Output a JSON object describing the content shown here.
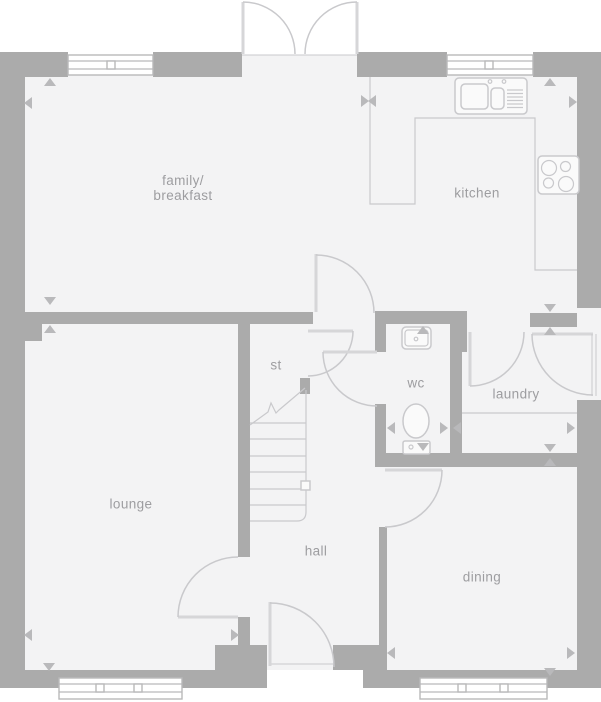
{
  "colors": {
    "wall": "#ababab",
    "floor": "#f3f3f4",
    "fixture_line": "#c9c9cc",
    "door_leaf": "#d6d6d8",
    "window_frame": "#b9b9ba",
    "label_text": "#9d9da0",
    "dimension_marker": "#b9b9bb",
    "background": "#ffffff"
  },
  "rooms": [
    {
      "id": "family-breakfast",
      "lines": [
        "family/",
        "breakfast"
      ]
    },
    {
      "id": "kitchen",
      "label": "kitchen"
    },
    {
      "id": "store",
      "label": "st"
    },
    {
      "id": "wc",
      "label": "wc"
    },
    {
      "id": "laundry",
      "label": "laundry"
    },
    {
      "id": "lounge",
      "label": "lounge"
    },
    {
      "id": "hall",
      "label": "hall"
    },
    {
      "id": "dining",
      "label": "dining"
    }
  ],
  "markers": [
    {
      "x": 50,
      "y": 82,
      "dir": "up"
    },
    {
      "x": 28,
      "y": 103,
      "dir": "left"
    },
    {
      "x": 365,
      "y": 101,
      "dir": "right"
    },
    {
      "x": 372,
      "y": 101,
      "dir": "left"
    },
    {
      "x": 573,
      "y": 102,
      "dir": "right"
    },
    {
      "x": 550,
      "y": 82,
      "dir": "up"
    },
    {
      "x": 550,
      "y": 308,
      "dir": "down"
    },
    {
      "x": 550,
      "y": 331,
      "dir": "up"
    },
    {
      "x": 50,
      "y": 301,
      "dir": "down"
    },
    {
      "x": 50,
      "y": 329,
      "dir": "up"
    },
    {
      "x": 49,
      "y": 667,
      "dir": "down"
    },
    {
      "x": 28,
      "y": 635,
      "dir": "left"
    },
    {
      "x": 235,
      "y": 635,
      "dir": "right"
    },
    {
      "x": 423,
      "y": 330,
      "dir": "up"
    },
    {
      "x": 423,
      "y": 447,
      "dir": "down"
    },
    {
      "x": 391,
      "y": 428,
      "dir": "left"
    },
    {
      "x": 444,
      "y": 428,
      "dir": "right"
    },
    {
      "x": 457,
      "y": 428,
      "dir": "left"
    },
    {
      "x": 571,
      "y": 428,
      "dir": "right"
    },
    {
      "x": 550,
      "y": 448,
      "dir": "down"
    },
    {
      "x": 550,
      "y": 462,
      "dir": "up"
    },
    {
      "x": 550,
      "y": 672,
      "dir": "down"
    },
    {
      "x": 391,
      "y": 653,
      "dir": "left"
    },
    {
      "x": 571,
      "y": 653,
      "dir": "right"
    }
  ]
}
